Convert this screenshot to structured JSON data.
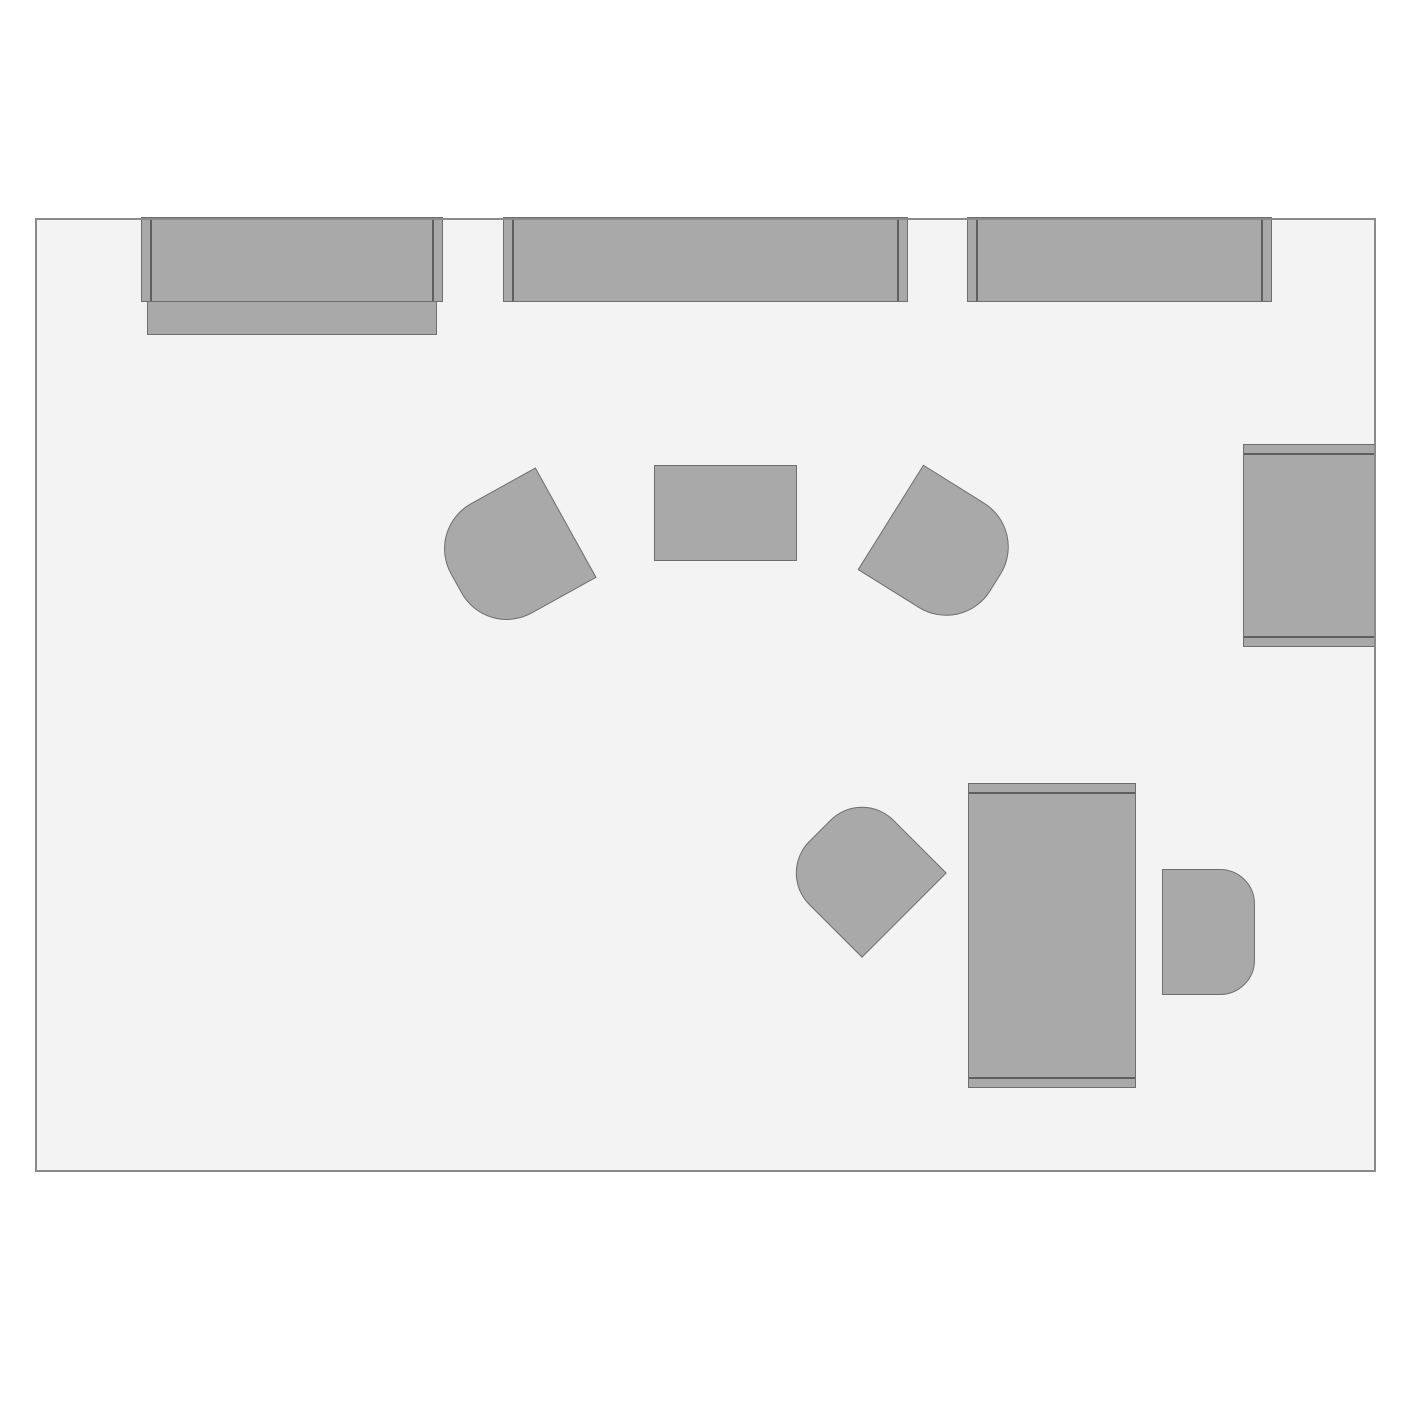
{
  "app": {
    "type": "floor-plan-canvas",
    "background": "#ffffff"
  },
  "room": {
    "x": 35,
    "y": 218,
    "width": 1341,
    "height": 954,
    "fill": "#f3f3f4",
    "border_color": "#8a8a8a",
    "border_width": 2
  },
  "furniture": {
    "fill": "#a9a9a9",
    "border_color": "#6e6e6e",
    "border_width": 1.5,
    "end_line_color": "#5f5f5f",
    "end_line_width": 2,
    "end_line_inset": 8,
    "items": [
      {
        "name": "desk-top-left",
        "kind": "desk",
        "x": 141,
        "y": 217,
        "w": 302,
        "h": 85,
        "rotation": 0,
        "ends": "horizontal"
      },
      {
        "name": "desk-top-left-return",
        "kind": "panel",
        "x": 147,
        "y": 301,
        "w": 290,
        "h": 34,
        "rotation": 0
      },
      {
        "name": "desk-top-center",
        "kind": "desk",
        "x": 503,
        "y": 217,
        "w": 405,
        "h": 85,
        "rotation": 0,
        "ends": "horizontal"
      },
      {
        "name": "desk-top-right",
        "kind": "desk",
        "x": 967,
        "y": 217,
        "w": 305,
        "h": 85,
        "rotation": 0,
        "ends": "horizontal"
      },
      {
        "name": "desk-right-wall",
        "kind": "desk",
        "x": 1243,
        "y": 444,
        "w": 133,
        "h": 203,
        "rotation": 0,
        "ends": "vertical"
      },
      {
        "name": "armchair-left",
        "kind": "chair",
        "x": 448,
        "y": 490,
        "w": 126,
        "h": 126,
        "rotation": -29,
        "round_side": "left",
        "corner_radius": 52
      },
      {
        "name": "coffee-table",
        "kind": "table",
        "x": 654,
        "y": 465,
        "w": 143,
        "h": 96,
        "rotation": 0
      },
      {
        "name": "armchair-right",
        "kind": "chair",
        "x": 881,
        "y": 488,
        "w": 124,
        "h": 124,
        "rotation": 32,
        "round_side": "right",
        "corner_radius": 52
      },
      {
        "name": "desk-bottom-right",
        "kind": "desk",
        "x": 968,
        "y": 783,
        "w": 168,
        "h": 305,
        "rotation": 0,
        "ends": "vertical"
      },
      {
        "name": "chair-desk-left",
        "kind": "chair",
        "x": 802,
        "y": 813,
        "w": 120,
        "h": 120,
        "rotation": 45,
        "round_side": "left",
        "corner_radius": 45
      },
      {
        "name": "chair-desk-right",
        "kind": "chair",
        "x": 1162,
        "y": 869,
        "w": 93,
        "h": 126,
        "rotation": 0,
        "round_side": "right",
        "corner_radius": 35
      }
    ]
  }
}
